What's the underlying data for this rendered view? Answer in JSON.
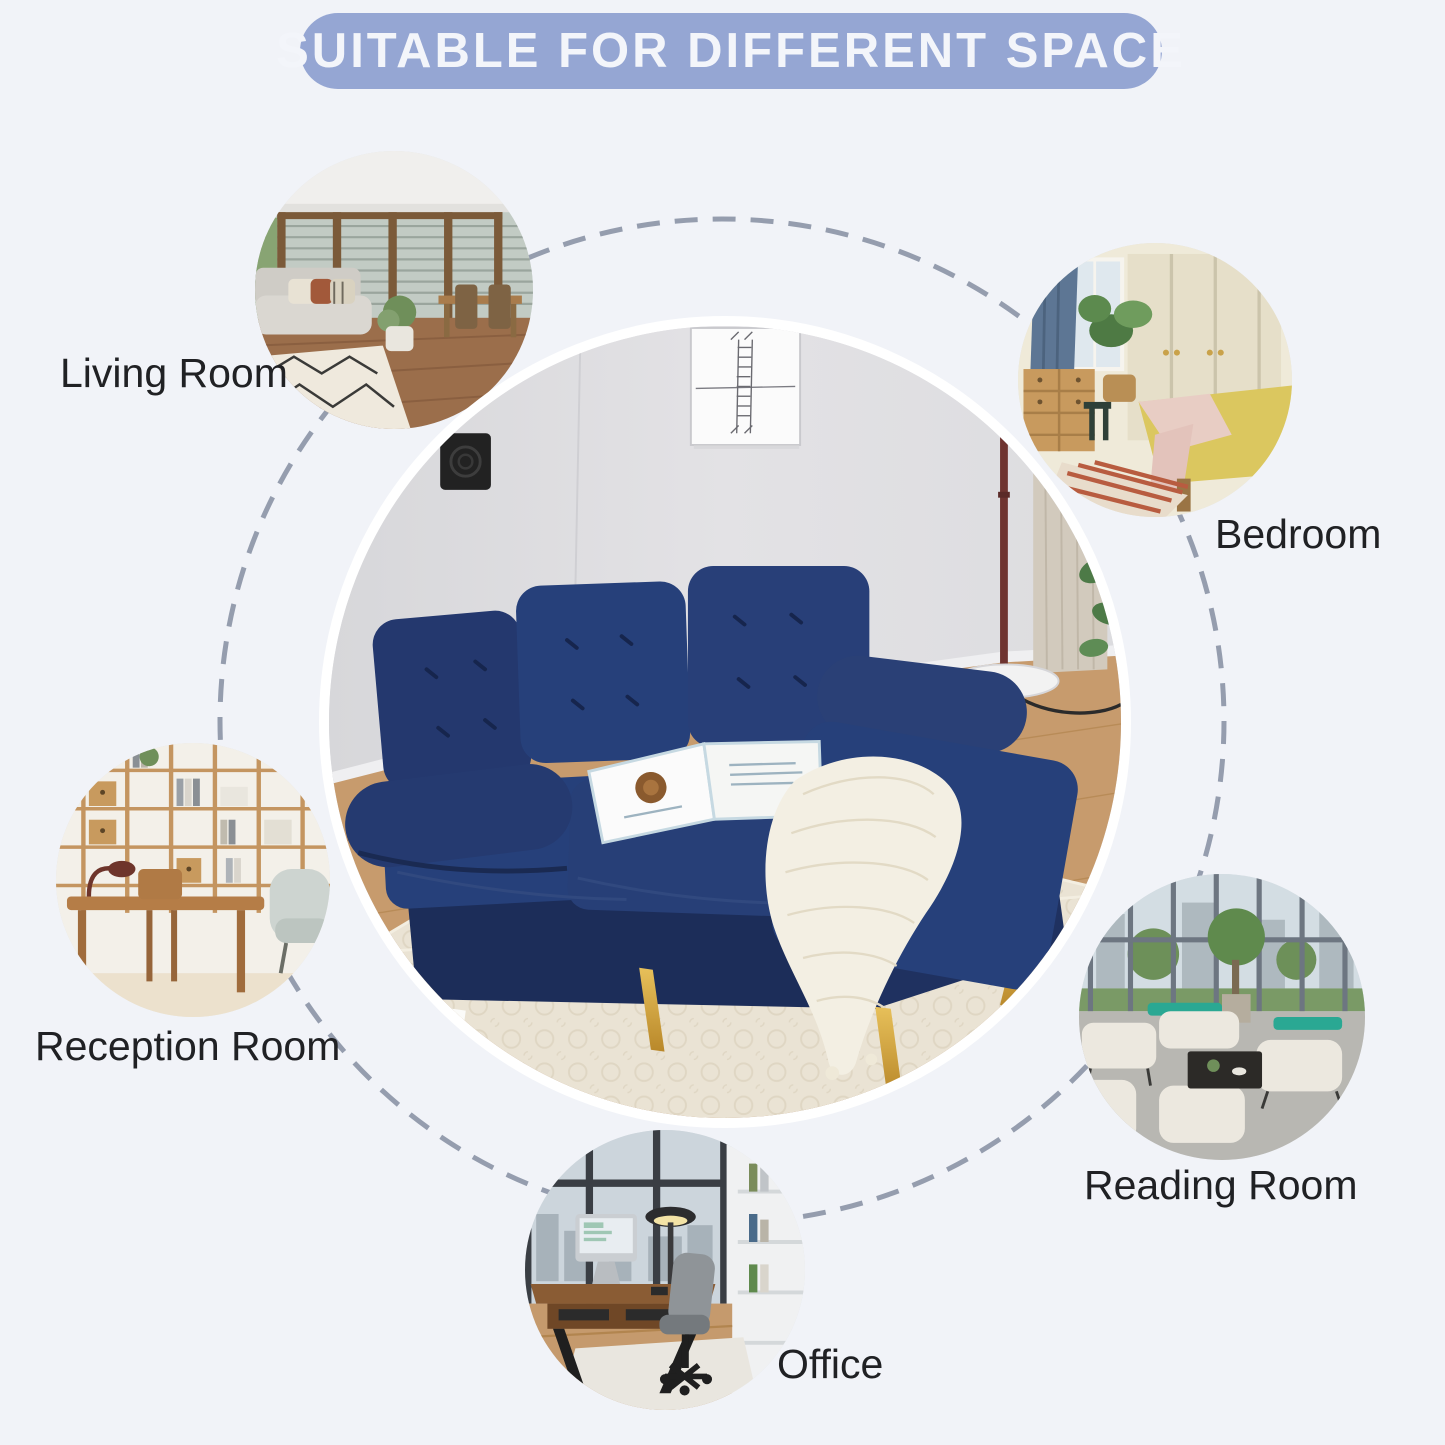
{
  "banner": {
    "label": "SUITABLE FOR DIFFERENT SPACE"
  },
  "spaces": [
    {
      "id": "living-room",
      "label": "Living Room"
    },
    {
      "id": "bedroom",
      "label": "Bedroom"
    },
    {
      "id": "reception-room",
      "label": "Reception Room"
    },
    {
      "id": "reading-room",
      "label": "Reading Room"
    },
    {
      "id": "office",
      "label": "Office"
    }
  ],
  "center_product": {
    "name": "navy-blue-sectional-sofa-with-chaise-and-gold-legs"
  },
  "colors": {
    "background": "#f1f3f8",
    "banner_fill": "#95a6d3",
    "banner_text": "#f3f5fa",
    "label_text": "#202124",
    "dashed_circle": "#959dae",
    "sofa_navy": "#22356a",
    "sofa_legs_gold": "#c79a33",
    "hero_ring": "#ffffff"
  }
}
